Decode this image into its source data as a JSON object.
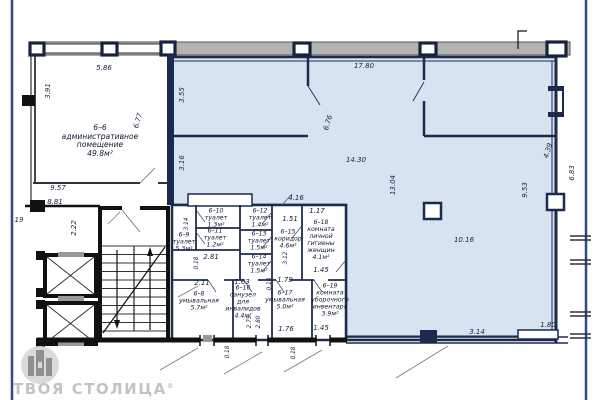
{
  "branding": {
    "logo_text": "ТВОЯ СТОЛИЦА",
    "registered_mark": "®"
  },
  "colors": {
    "hall_fill": "#d6e3f1",
    "wall_navy": "#1c2b4d",
    "wall_black": "#111111",
    "top_band_gray": "#b3b3b3",
    "frame_blue": "#2c4a8c",
    "logo_gray": "#c3c3c3"
  },
  "rooms": {
    "r6_6": {
      "label": "6–6\nадминистративное\nпомещение\n49.8м²"
    },
    "r6_8": {
      "label": "6–8\nумывальная\n5.7м²"
    },
    "r6_9": {
      "label": "6–9\nтуалет\n5.3м²"
    },
    "r6_10": {
      "label": "6–10\nтуалет\n1.3м²"
    },
    "r6_11": {
      "label": "6–11\nтуалет\n1.2м²"
    },
    "r6_12": {
      "label": "6–12\nтуалет\n1.4м²"
    },
    "r6_13": {
      "label": "6–13\nтуалет\n1.5м²"
    },
    "r6_14": {
      "label": "6–14\nтуалет\n1.5м²"
    },
    "r6_15": {
      "label": "6–15\nкоридор\n4.6м²"
    },
    "r6_16": {
      "label": "6–16\nсанузел\nдля\nинвалидов\n4.4м²"
    },
    "r6_17": {
      "label": "6–17\nумывальная\n5.0м²"
    },
    "r6_18": {
      "label": "6–18\nкомната\nличной\nгигиены\nженщин\n4.1м²"
    },
    "r6_19": {
      "label": "6–19\nкомната\nуборочного\nинвентаря\n3.9м²"
    }
  },
  "dims": {
    "d5_86": "5.86",
    "d3_91": "3.91",
    "d6_77": "6.77",
    "d17_80": "17.80",
    "d3_55": "3.55",
    "d3_16": "3.16",
    "d6_76": "6.76",
    "d14_30": "14.30",
    "d13_04": "13.04",
    "d9_53": "9.53",
    "d4_39": "4.39",
    "d6_83": "6.83",
    "d10_16": "10.16",
    "d3_14_bottom": "3.14",
    "d1_80": "1.80",
    "d4_16": "4.16",
    "d9_57": "9.57",
    "d8_81": "8.81",
    "d19": "19",
    "d2_22": "2.22",
    "d3_14_wc": "3.14",
    "d0_18_a": "0.18",
    "d2_81": "2.81",
    "d1_51": "1.51",
    "d1_17": "1.17",
    "d3_12": "3.12",
    "d1_45_a": "1.45",
    "d2_11": "2.11",
    "d1_63": "1.63",
    "d1_79": "1.79",
    "d0_18_b": "0.18",
    "d2_75": "2.75",
    "d2_80": "2.80",
    "d1_76": "1.76",
    "d1_45_b": "1.45",
    "d0_18_c": "0.18",
    "d0_18_d": "0.18"
  }
}
